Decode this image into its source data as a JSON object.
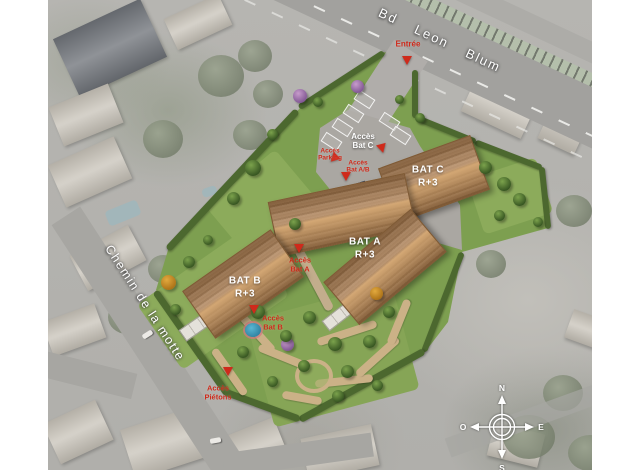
{
  "image_type": "aerial-site-plan",
  "streets": {
    "boulevard": "Bd Leon Blum",
    "chemin": "Chemin de la motte"
  },
  "entrance_label": "Entrée",
  "buildings": [
    {
      "name": "BAT A",
      "level": "R+3"
    },
    {
      "name": "BAT B",
      "level": "R+3"
    },
    {
      "name": "BAT C",
      "level": "R+3"
    }
  ],
  "access_labels": {
    "bat_c": "Accès\nBat C",
    "parking": "Accès\nParking",
    "bat_ab": "Accès\nBat A/B",
    "bat_a": "Accès\nBat A",
    "bat_b": "Accès\nBat B",
    "pietons": "Accès\nPiétons"
  },
  "compass": {
    "n": "N",
    "s": "S",
    "e": "E",
    "o": "O"
  },
  "colors": {
    "marker_red": "#cf2a1b",
    "lawn_green": "#7d9f50",
    "roof_brown": "#a87a4e",
    "label_white": "#ffffff"
  }
}
